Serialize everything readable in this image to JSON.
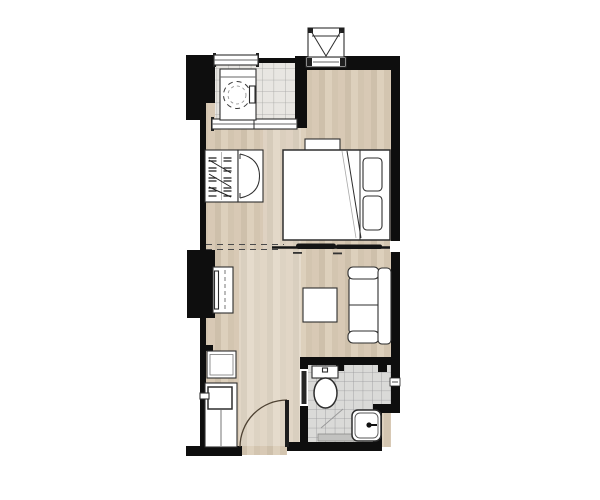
{
  "plan": {
    "kind": "studio-apartment-floor-plan",
    "view": "top-down",
    "rooms": [
      {
        "name": "balcony",
        "floor": "tile",
        "fixtures": [
          "washing-machine",
          "sliding-window-top",
          "sliding-door-bottom",
          "railing"
        ]
      },
      {
        "name": "bedroom",
        "floor": "wood",
        "fixtures": [
          "double-bed",
          "pillow",
          "pillow",
          "nightstand",
          "open-wardrobe-hangers",
          "wardrobe-cabinet-double-door",
          "sliding-partition"
        ]
      },
      {
        "name": "living-area",
        "floor": "wood",
        "fixtures": [
          "sofa-two-seat",
          "coffee-table",
          "tv-cabinet"
        ]
      },
      {
        "name": "kitchenette",
        "floor": "wood",
        "fixtures": [
          "appliance-square",
          "counter",
          "sink",
          "faucet"
        ]
      },
      {
        "name": "bathroom",
        "floor": "tile",
        "fixtures": [
          "toilet",
          "washbasin",
          "faucet-knob",
          "floor-drain-strip",
          "slope-line",
          "bathroom-door",
          "wall-niche"
        ]
      },
      {
        "name": "entrance",
        "floor": "wood",
        "fixtures": [
          "entry-door-leaf",
          "entry-door-swing-arc",
          "threshold"
        ]
      }
    ],
    "exterior_items": [
      "ac-condenser-unit",
      "ac-wall-vent",
      "service-shaft-column",
      "structural-wall-block"
    ]
  },
  "colors": {
    "wall": "#0e0e0e",
    "line": "#2e2e2e",
    "accentDark": "#1f1f1f",
    "wood1": "#d8c9b5",
    "wood2": "#cec0ab",
    "wood3": "#ddd0bc",
    "wood4": "#d3c5b0",
    "balconyTile": "#e8e6e2",
    "balconyGrid": "#a3a3a1",
    "bathTile": "#dadad8",
    "bathGrid": "#97979a",
    "arcColor": "#4e4233",
    "background": "#ffffff"
  }
}
